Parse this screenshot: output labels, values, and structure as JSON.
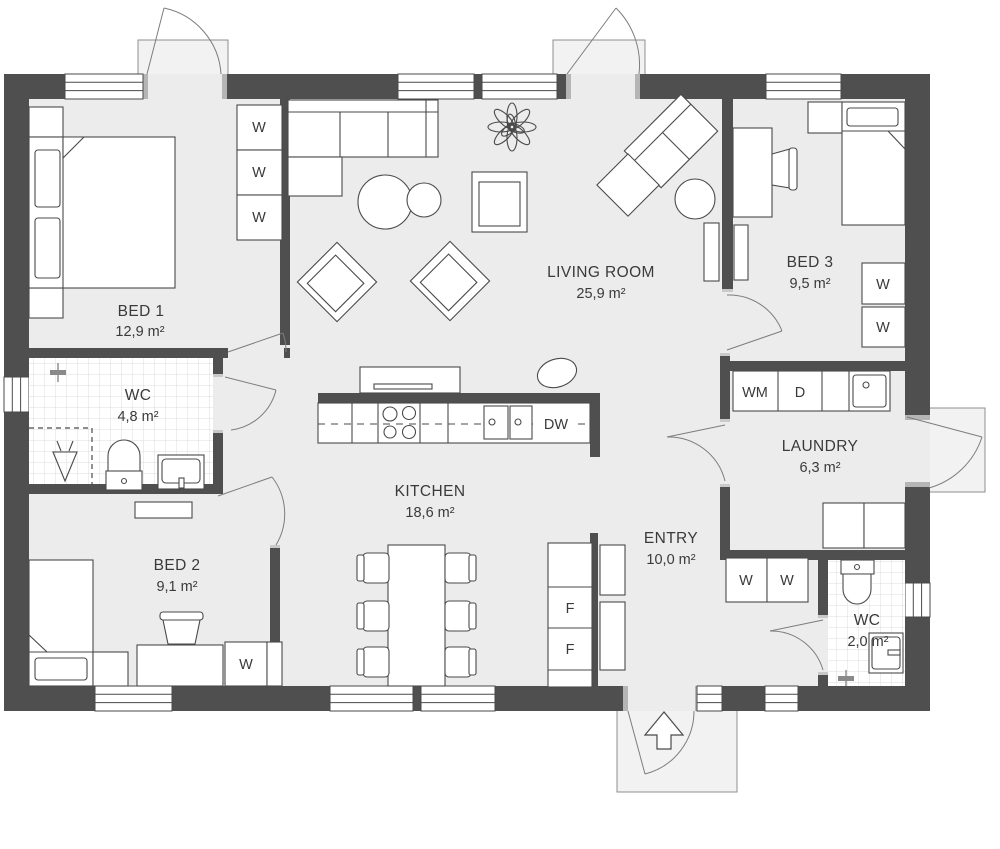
{
  "colors": {
    "wall": "#4f4f4f",
    "floor": "#ececec",
    "porch": "#f2f2f2",
    "tile_line": "#dcdcdc",
    "furniture_line": "#4a4a4a",
    "text": "#3a3a3a"
  },
  "rooms": [
    {
      "id": "bed1",
      "name": "BED 1",
      "area": "12,9 m²"
    },
    {
      "id": "wc1",
      "name": "WC",
      "area": "4,8 m²"
    },
    {
      "id": "bed2",
      "name": "BED 2",
      "area": "9,1 m²"
    },
    {
      "id": "living",
      "name": "LIVING ROOM",
      "area": "25,9 m²"
    },
    {
      "id": "kitchen",
      "name": "KITCHEN",
      "area": "18,6 m²"
    },
    {
      "id": "bed3",
      "name": "BED 3",
      "area": "9,5 m²"
    },
    {
      "id": "laundry",
      "name": "LAUNDRY",
      "area": "6,3 m²"
    },
    {
      "id": "entry",
      "name": "ENTRY",
      "area": "10,0 m²"
    },
    {
      "id": "wc2",
      "name": "WC",
      "area": "2,0 m²"
    }
  ],
  "fixtures": {
    "bed1_wardrobe": [
      "W",
      "W",
      "W"
    ],
    "bed3_wardrobe": [
      "W",
      "W"
    ],
    "bed2_wardrobe": [
      "W"
    ],
    "entry_wardrobe": [
      "W",
      "W"
    ],
    "laundry_appliances": {
      "washing_machine": "WM",
      "dryer": "D"
    },
    "kitchen_appliances": {
      "dishwasher": "DW",
      "freezer": [
        "F",
        "F"
      ]
    }
  }
}
